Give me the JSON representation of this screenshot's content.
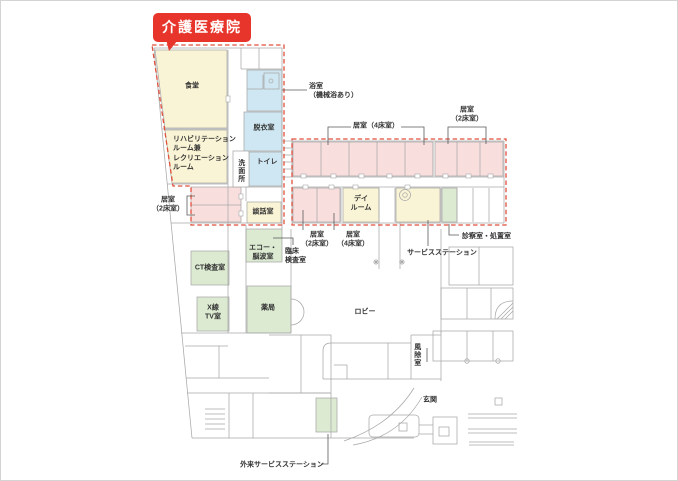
{
  "title": {
    "text": "介護医療院"
  },
  "colors": {
    "red": "#e8352b",
    "dashed": "#e0503c",
    "yellow": "#faf4d6",
    "blue": "#cfe7f2",
    "pink": "#f9dede",
    "green": "#dcead2",
    "wall": "#a8a8a8",
    "text": "#333333"
  },
  "rooms": {
    "dining": {
      "label": "食堂"
    },
    "rehab": {
      "label": "リハビリテーション\nルーム兼\nレクリエーション\nルーム"
    },
    "room2_left": {
      "label": "居室\n（2床室）"
    },
    "bath": {
      "label": "浴室\n（機械浴あり）"
    },
    "undress": {
      "label": "脱衣室"
    },
    "toilet": {
      "label": "トイレ"
    },
    "washroom": {
      "label": "洗面所"
    },
    "lounge": {
      "label": "談話室"
    },
    "room4_top": {
      "label": "居室（4床室）"
    },
    "room2_top": {
      "label": "居室\n（2床室）"
    },
    "dayroom": {
      "label": "デイ\nルーム"
    },
    "room2_mid": {
      "label": "居室\n（2床室）"
    },
    "room4_mid": {
      "label": "居室\n（4床室）"
    },
    "service_station": {
      "label": "サービスステーション"
    },
    "exam": {
      "label": "診察室・処置室"
    },
    "clinical_lab": {
      "label": "臨床\n検査室"
    },
    "echo": {
      "label": "エコー・\n脳波室"
    },
    "ct": {
      "label": "CT検査室"
    },
    "xray": {
      "label": "X線\nTV室"
    },
    "pharmacy": {
      "label": "薬局"
    },
    "lobby": {
      "label": "ロビー"
    },
    "windbreak": {
      "label": "風除室"
    },
    "entrance": {
      "label": "玄関"
    },
    "outpatient_station": {
      "label": "外来サービスステーション"
    }
  }
}
